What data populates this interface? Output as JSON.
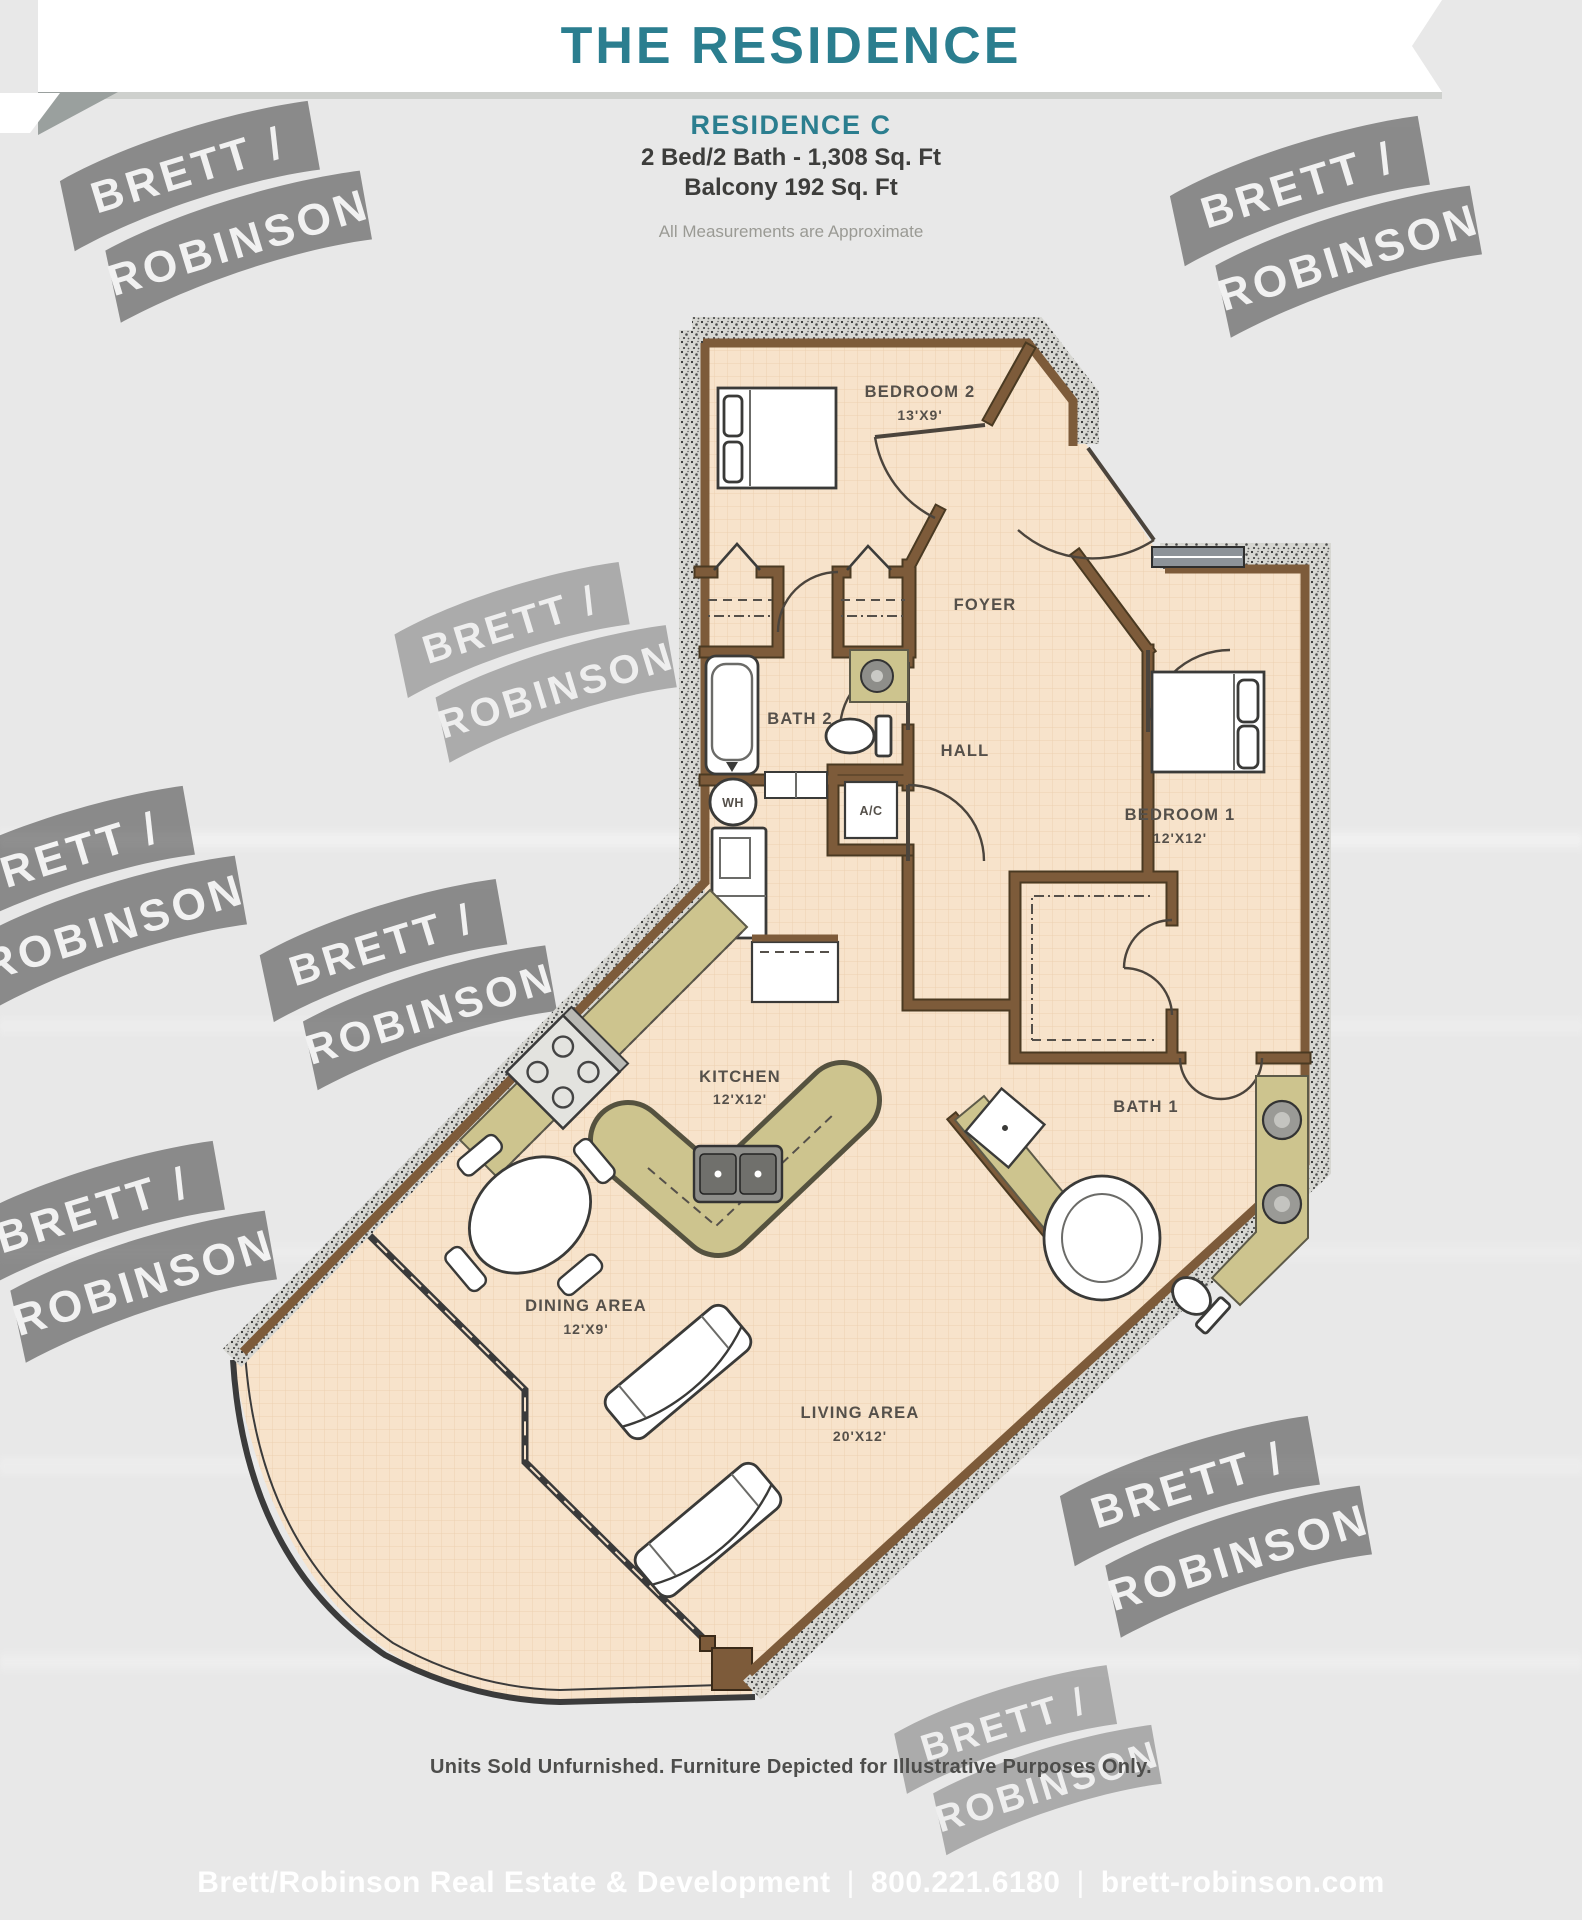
{
  "banner": {
    "title": "THE RESIDENCE",
    "title_color": "#2b7e8f"
  },
  "header": {
    "plan_name": "RESIDENCE C",
    "specs_line1": "2 Bed/2 Bath - 1,308 Sq. Ft",
    "specs_line2": "Balcony 192 Sq. Ft",
    "note": "All Measurements are Approximate"
  },
  "watermark": {
    "line1": "BRETT /",
    "line2": "ROBINSON"
  },
  "floorplan": {
    "rooms": {
      "bedroom2": {
        "name": "BEDROOM 2",
        "size": "13'X9'"
      },
      "foyer": {
        "name": "FOYER"
      },
      "bath2": {
        "name": "BATH 2"
      },
      "hall": {
        "name": "HALL"
      },
      "water_heater": {
        "name": "WH"
      },
      "ac": {
        "name": "A/C"
      },
      "bedroom1": {
        "name": "BEDROOM 1",
        "size": "12'X12'"
      },
      "bath1": {
        "name": "BATH 1"
      },
      "kitchen": {
        "name": "KITCHEN",
        "size": "12'X12'"
      },
      "dining": {
        "name": "DINING AREA",
        "size": "12'X9'"
      },
      "living": {
        "name": "LIVING AREA",
        "size": "20'X12'"
      }
    },
    "colors": {
      "floor": "#f7e3cb",
      "floor_grid": "#ecd0b0",
      "wall_brown": "#7d5b3a",
      "counter_olive": "#cdc48e",
      "exterior_stipple": "#d7d7d2",
      "accent_teal": "#2b7e8f",
      "footer_blue": "#8dafc1"
    }
  },
  "footer": {
    "disclaimer": "Units Sold Unfurnished. Furniture Depicted for Illustrative Purposes Only.",
    "company": "Brett/Robinson Real Estate & Development",
    "separator": "|",
    "phone": "800.221.6180",
    "website": "brett-robinson.com"
  }
}
